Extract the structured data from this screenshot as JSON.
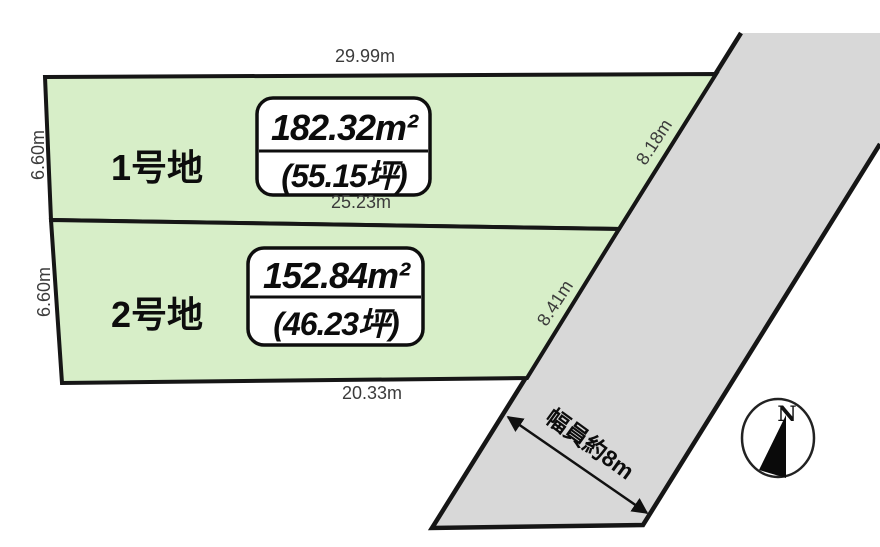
{
  "title": "land-plot-layout-diagram",
  "colors": {
    "background": "#ffffff",
    "parcel_fill": "#d7eec8",
    "road_fill": "#d8d8d8",
    "line": "#161616",
    "dim_text": "#3b3b3b",
    "label_text": "#0d0d0d"
  },
  "parcels": [
    {
      "name": "1号地",
      "area_m2": "182.32m²",
      "area_tsubo": "(55.15坪)",
      "dim_top": "29.99m",
      "dim_left": "6.60m",
      "dim_right": "8.18m",
      "dim_bottom": "25.23m"
    },
    {
      "name": "2号地",
      "area_m2": "152.84m²",
      "area_tsubo": "(46.23坪)",
      "dim_left": "6.60m",
      "dim_right": "8.41m",
      "dim_bottom": "20.33m"
    }
  ],
  "road": {
    "width_label": "幅員約8m"
  },
  "compass": {
    "north_label": "N"
  }
}
